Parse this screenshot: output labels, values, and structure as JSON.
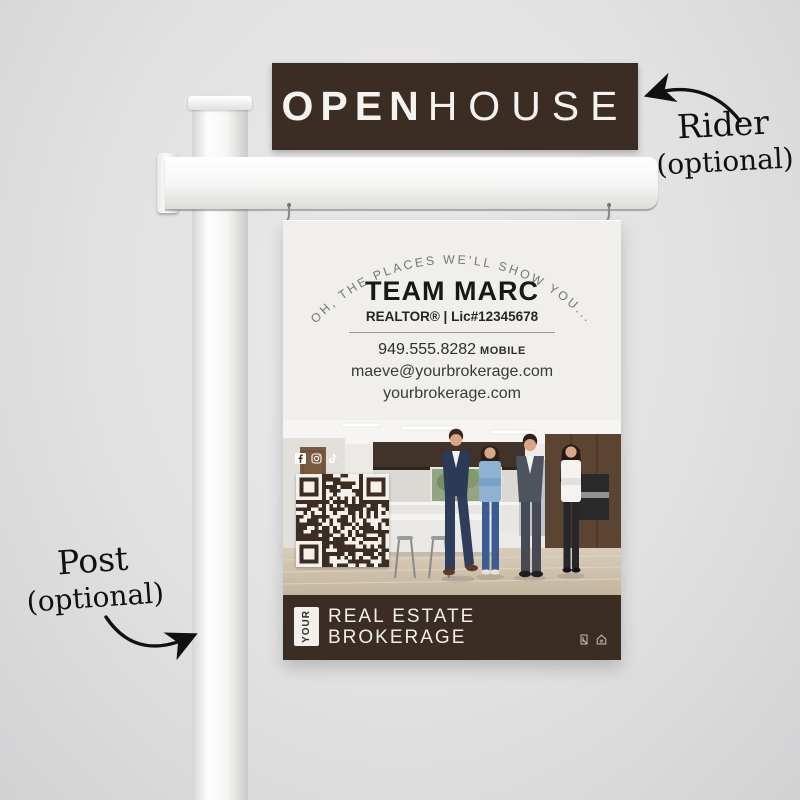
{
  "rider": {
    "word_bold": "OPEN",
    "word_light": "HOUSE"
  },
  "annotations": {
    "rider_label": "Rider",
    "rider_sub": "(optional)",
    "post_label": "Post",
    "post_sub": "(optional)"
  },
  "sign": {
    "arch_text": "OH, THE PLACES WE’LL SHOW YOU...",
    "agent_name": "TEAM MARC",
    "credentials": "REALTOR® | Lic#12345678",
    "phone": "949.555.8282",
    "phone_tag": "MOBILE",
    "email": "maeve@yourbrokerage.com",
    "website": "yourbrokerage.com",
    "social": [
      "facebook",
      "instagram",
      "tiktok"
    ],
    "footer": {
      "logo_word": "YOUR",
      "brand_line1": "REAL ESTATE",
      "brand_line2": "BROKERAGE",
      "compliance_icons": [
        "realtor-mls",
        "equal-housing"
      ]
    }
  },
  "colors": {
    "brand_brown": "#3b2d23",
    "sign_offwhite": "#f0efec",
    "arch_gray": "#757575",
    "text_dark": "#181818"
  }
}
